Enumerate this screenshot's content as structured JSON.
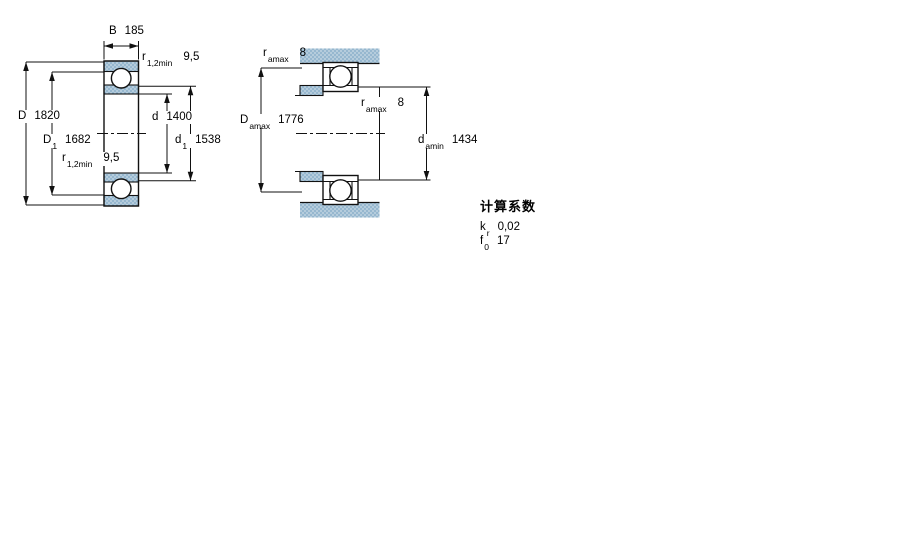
{
  "drawing": {
    "left_figure": {
      "B": {
        "sym": "B",
        "value": "185"
      },
      "r_top": {
        "sym": "r",
        "sub": "1,2min",
        "value": "9,5"
      },
      "D": {
        "sym": "D",
        "value": "1820"
      },
      "D1": {
        "sym": "D",
        "sub": "1",
        "value": "1682"
      },
      "r_bottom": {
        "sym": "r",
        "sub": "1,2min",
        "value": "9,5"
      },
      "d": {
        "sym": "d",
        "value": "1400"
      },
      "d1": {
        "sym": "d",
        "sub": "1",
        "value": "1538"
      }
    },
    "right_figure": {
      "ra_top": {
        "sym": "r",
        "sub": "amax",
        "value": "8"
      },
      "Da": {
        "sym": "D",
        "sub": "amax",
        "value": "1776"
      },
      "ra_mid": {
        "sym": "r",
        "sub": "amax",
        "value": "8"
      },
      "da": {
        "sym": "d",
        "sub": "amin",
        "value": "1434"
      }
    },
    "factors": {
      "heading": "计算系数",
      "kr": {
        "sym": "k",
        "sub": "r",
        "value": "0,02"
      },
      "f0": {
        "sym": "f",
        "sub": "0",
        "value": "17"
      }
    },
    "colors": {
      "section_fill": "#b5ccdc",
      "section_dot": "#7fa9c6",
      "line": "#111111",
      "background": "#ffffff"
    }
  }
}
